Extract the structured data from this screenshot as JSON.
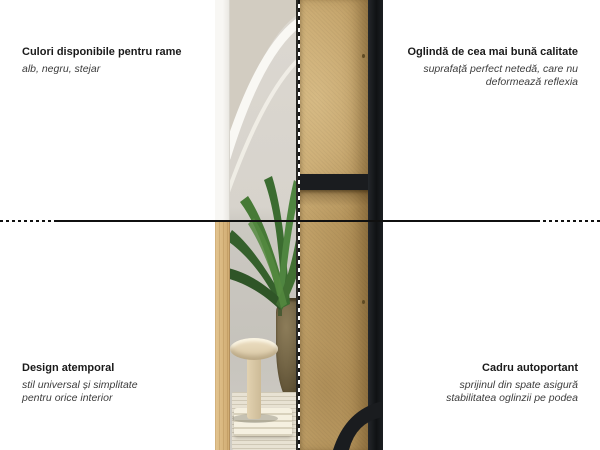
{
  "annotations": {
    "top_left": {
      "title": "Culori disponibile pentru rame",
      "subtitle": "alb, negru, stejar"
    },
    "top_right": {
      "title": "Oglindă de cea mai bună calitate",
      "subtitle_line1": "suprafață perfect netedă, care nu",
      "subtitle_line2": "deformează reflexia"
    },
    "bottom_left": {
      "title": "Design atemporal",
      "subtitle_line1": "stil universal și simplitate",
      "subtitle_line2": "pentru orice interior"
    },
    "bottom_right": {
      "title": "Cadru autoportant",
      "subtitle_line1": "sprijinul din spate asigură",
      "subtitle_line2": "stabilitatea oglinzii pe podea"
    }
  },
  "colors": {
    "background": "#ffffff",
    "callout_line": "#101010",
    "title_text": "#1a1a1a",
    "subtitle_text": "#3c3c3c",
    "frame_white": "#f8f7f4",
    "frame_oak": "#d8b77f",
    "frame_black": "#1a1c1f",
    "mirror_back_mdf": "#c3a269",
    "plant_green": "#3f7234"
  }
}
